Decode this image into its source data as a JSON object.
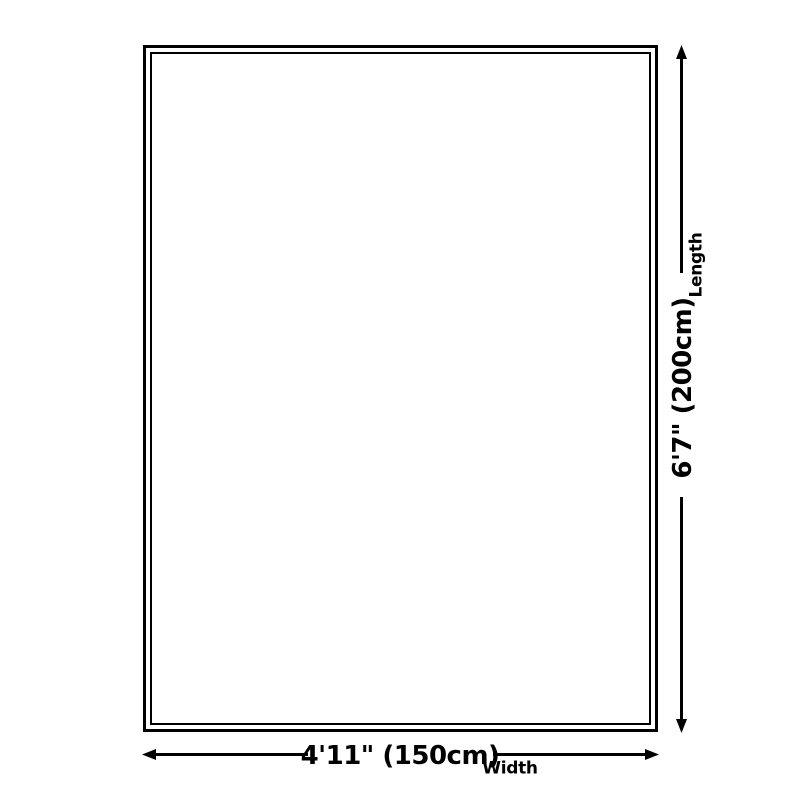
{
  "diagram": {
    "length": {
      "value": "6'7\" (200cm)",
      "label": "Length"
    },
    "width": {
      "value": "4'11\" (150cm)",
      "label": "Width"
    }
  },
  "colors": {
    "line": "#000000",
    "bg": "#ffffff"
  }
}
